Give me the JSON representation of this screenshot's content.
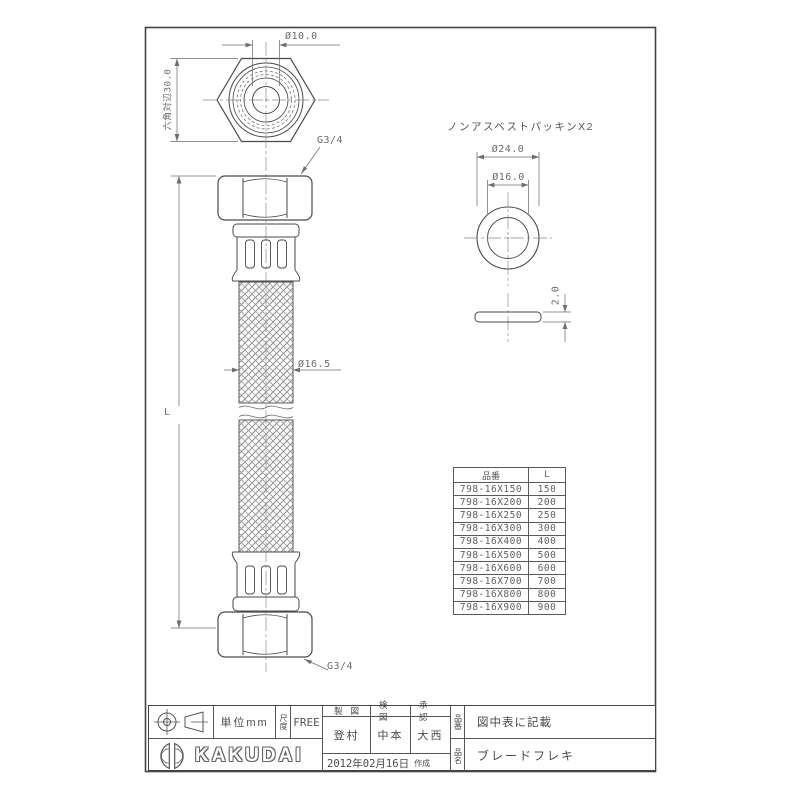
{
  "drawing": {
    "top_view": {
      "bore_dim": "Ø10.0",
      "across_flats_dim": "六角対辺30.0",
      "thread_label_top": "G3/4"
    },
    "front_view": {
      "hose_od_dim": "Ø16.5",
      "length_dim": "L",
      "thread_label_bottom": "G3/4"
    },
    "packing": {
      "title": "ノンアスベストパッキンX2",
      "outer_dia_dim": "Ø24.0",
      "inner_dia_dim": "Ø16.0",
      "thickness_dim": "2.0"
    }
  },
  "size_table": {
    "headers": [
      "品番",
      "L"
    ],
    "rows": [
      [
        "798-16X150",
        "150"
      ],
      [
        "798-16X200",
        "200"
      ],
      [
        "798-16X250",
        "250"
      ],
      [
        "798-16X300",
        "300"
      ],
      [
        "798-16X400",
        "400"
      ],
      [
        "798-16X500",
        "500"
      ],
      [
        "798-16X600",
        "600"
      ],
      [
        "798-16X700",
        "700"
      ],
      [
        "798-16X800",
        "800"
      ],
      [
        "798-16X900",
        "900"
      ]
    ]
  },
  "title_block": {
    "unit_label": "単位mm",
    "scale_label": "尺度",
    "scale_value": "FREE",
    "drawn_label": "製図",
    "checked_label": "検図",
    "approved_label": "承認",
    "drawn_by": "登村",
    "checked_by": "中本",
    "approved_by": "大西",
    "date": "2012年02月16日",
    "date_suffix": "作成",
    "part_no_label": "品番",
    "part_no_value": "図中表に記載",
    "product_name_label": "品名",
    "product_name_value": "ブレードフレキ",
    "brand": "KAKUDAI"
  },
  "colors": {
    "line": "#4a4a4a",
    "thin_line": "#6f6f6f",
    "text": "#555555",
    "background": "#ffffff"
  }
}
